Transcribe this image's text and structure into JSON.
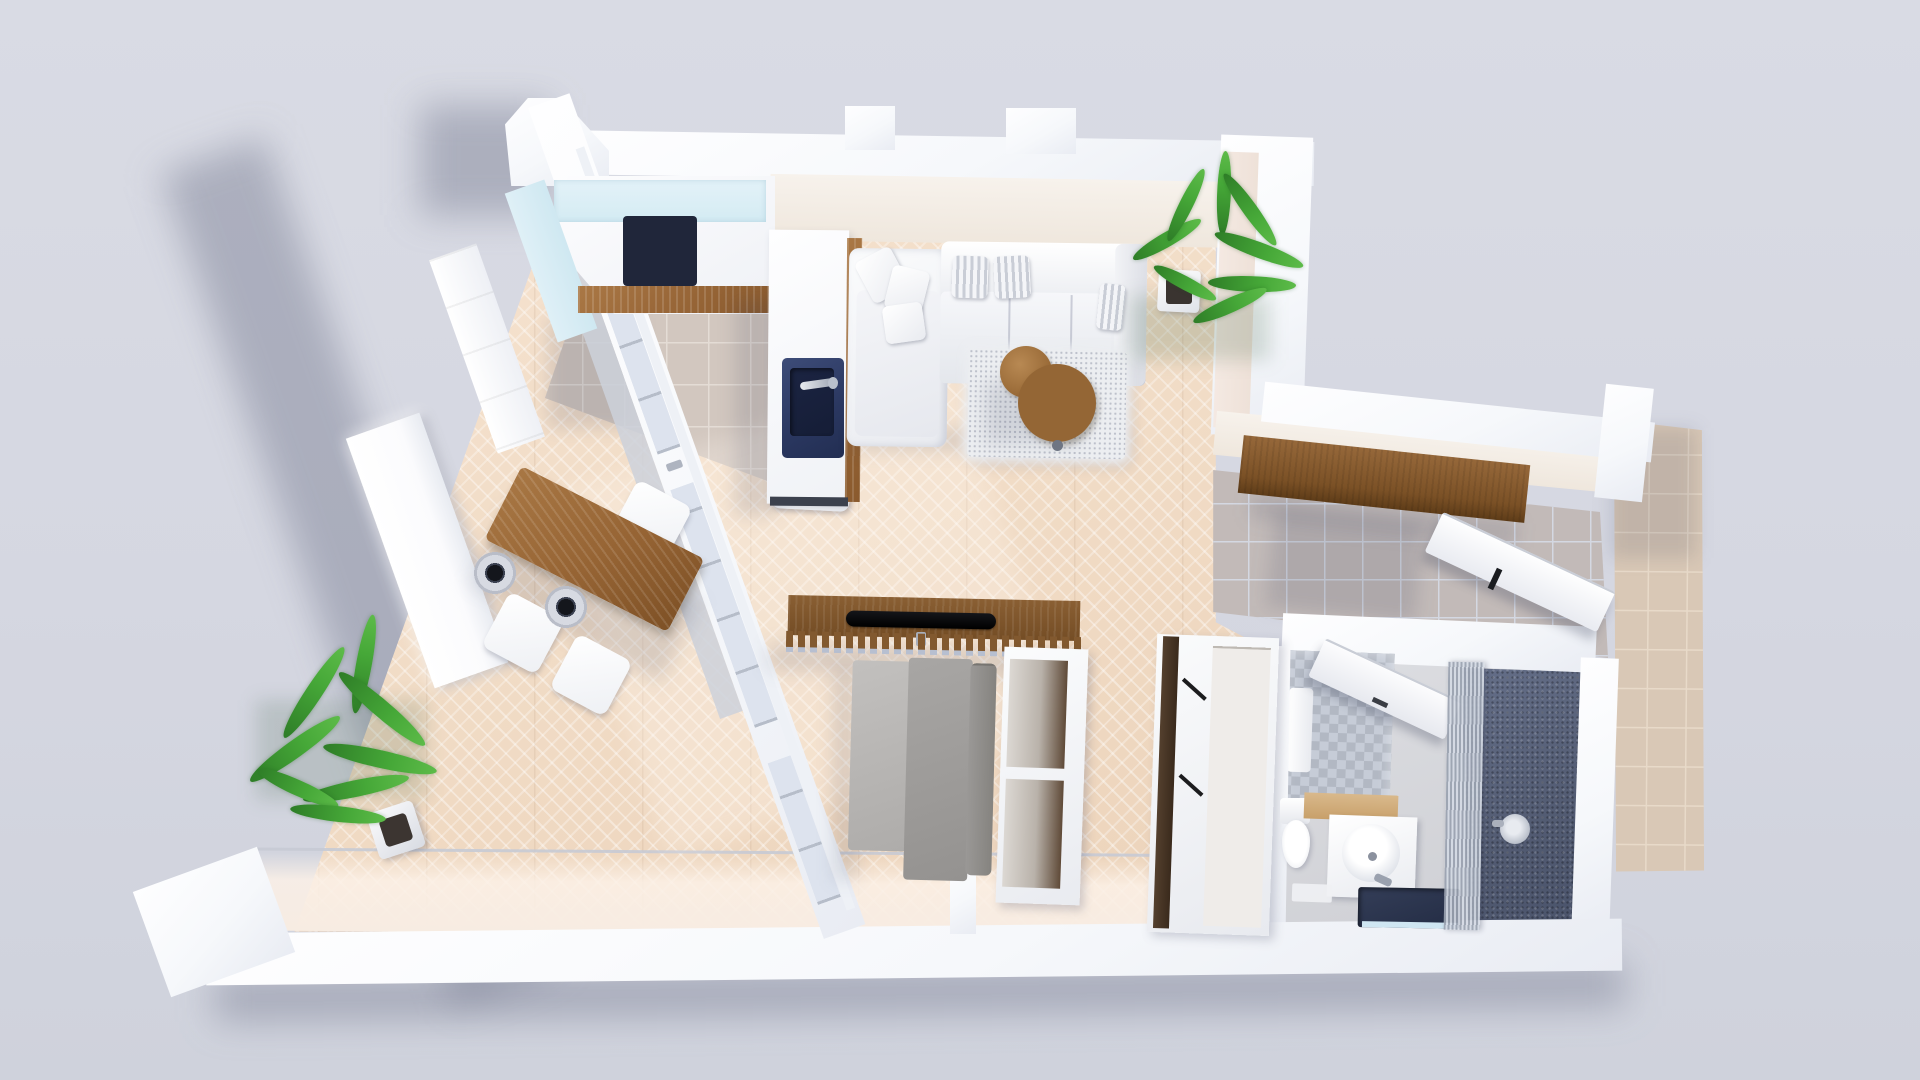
{
  "scene": {
    "type": "3d-floor-plan-top-down-render",
    "description": "Photorealistic top-down 3D render of a studio apartment floor plan on a plain light grey backdrop",
    "background_color": "#d5d7e1",
    "visible_text": "none"
  },
  "palette": {
    "wall_white": "#fafbfd",
    "wood_floor": "#f1dcc7",
    "kitchen_tile": "#d3c8c0",
    "hall_tile": "#c3bbb9",
    "balcony_tile": "#dbc9b8",
    "bath_floor": "#d4d5d9",
    "shower_floor": "#5b647a",
    "accent_navy": "#2e3c64",
    "furniture_wood": "#9c6b3c",
    "plant_green": "#3e9c34",
    "sofa_white": "#f4f5f8",
    "sofa_bed_gray": "#9e9c9a",
    "counter_glass": "#d9edf4"
  },
  "rooms": [
    {
      "id": "kitchen",
      "label": "Kitchen"
    },
    {
      "id": "living-dining",
      "label": "Living / dining area"
    },
    {
      "id": "hallway",
      "label": "Entry hallway"
    },
    {
      "id": "bathroom",
      "label": "Bathroom with walk-in shower"
    },
    {
      "id": "balcony",
      "label": "Outside tiled strip"
    }
  ],
  "furniture": [
    {
      "label": "Kitchen counter with glass top"
    },
    {
      "label": "Induction cooktop with 4 burners"
    },
    {
      "label": "Kitchen island"
    },
    {
      "label": "Navy island sink with faucet"
    },
    {
      "label": "Wooden dining table"
    },
    {
      "label": "Pendant lamp"
    },
    {
      "label": "White dining chair"
    },
    {
      "label": "White sectional sofa with chaise"
    },
    {
      "label": "Shaggy area rug"
    },
    {
      "label": "Round wooden coffee table"
    },
    {
      "label": "Potted palm plant"
    },
    {
      "label": "Slatted wood media console"
    },
    {
      "label": "Flat-screen TV"
    },
    {
      "label": "Gray sofa bed"
    },
    {
      "label": "Open shelving unit"
    },
    {
      "label": "Wardrobe with open shelves"
    },
    {
      "label": "Entry console shelf"
    },
    {
      "label": "Open entry door"
    },
    {
      "label": "Open bathroom door"
    },
    {
      "label": "Toilet"
    },
    {
      "label": "Vanity with round basin"
    },
    {
      "label": "Dark countertop basin"
    },
    {
      "label": "Walk-in shower"
    },
    {
      "label": "Shower head"
    },
    {
      "label": "Glazed window wall"
    },
    {
      "label": "Window-side sideboard"
    }
  ]
}
